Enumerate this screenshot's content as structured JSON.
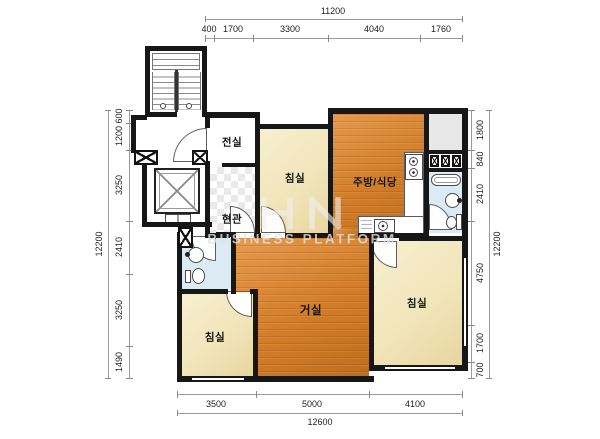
{
  "rooms": {
    "vestibule": "전실",
    "entry": "현관",
    "bedroom_top": "침실",
    "kitchen_dining": "주방/식당",
    "living": "거실",
    "bedroom_right": "침실",
    "bedroom_left": "침실"
  },
  "dims": {
    "top": {
      "total": "11200",
      "segments": [
        "400",
        "1700",
        "3300",
        "4040",
        "1760"
      ]
    },
    "left": {
      "total": "12200",
      "segments": [
        "600",
        "1200",
        "3250",
        "2410",
        "3250",
        "1490"
      ]
    },
    "right": {
      "total": "12200",
      "segments": [
        "1800",
        "840",
        "2410",
        "4750",
        "1700",
        "700"
      ]
    },
    "bottom": {
      "total": "12600",
      "segments": [
        "3500",
        "5000",
        "4100"
      ]
    }
  },
  "watermark": {
    "text": "BUSINESS PLATFORM"
  },
  "colors": {
    "wall": "#171717",
    "wood_floor": "#d27d28",
    "bedroom_floor": "#f1e5ba",
    "bath_floor": "#dcebf3",
    "utility_floor": "#e8e8e8",
    "dimension_text": "#222222"
  }
}
